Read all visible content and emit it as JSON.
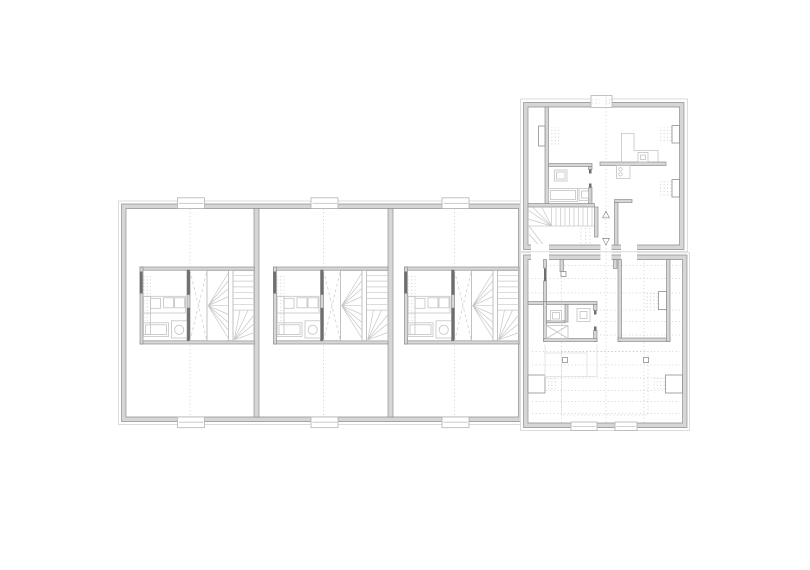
{
  "canvas": {
    "width": 810,
    "height": 570,
    "background": "#ffffff"
  },
  "plan": {
    "kind": "floor-plan-drawing",
    "colors": {
      "background": "#ffffff",
      "wall_fill": "#d6d6d6",
      "wall_edge": "#8f8f8f",
      "thin_outline": "#cdcdcd",
      "fixture_line": "#c3c3c3",
      "stair_line": "#c7c7c7",
      "dotted_line": "#c6c6c6",
      "door_leaf": "#6e6e6e"
    },
    "markers": {
      "stairs_up": "△",
      "stairs_down": "▽"
    },
    "buildings": {
      "row_building": {
        "label": "row-building",
        "unit_count": 3
      },
      "north_house": {
        "label": "north-house"
      },
      "south_house": {
        "label": "south-house"
      }
    }
  }
}
